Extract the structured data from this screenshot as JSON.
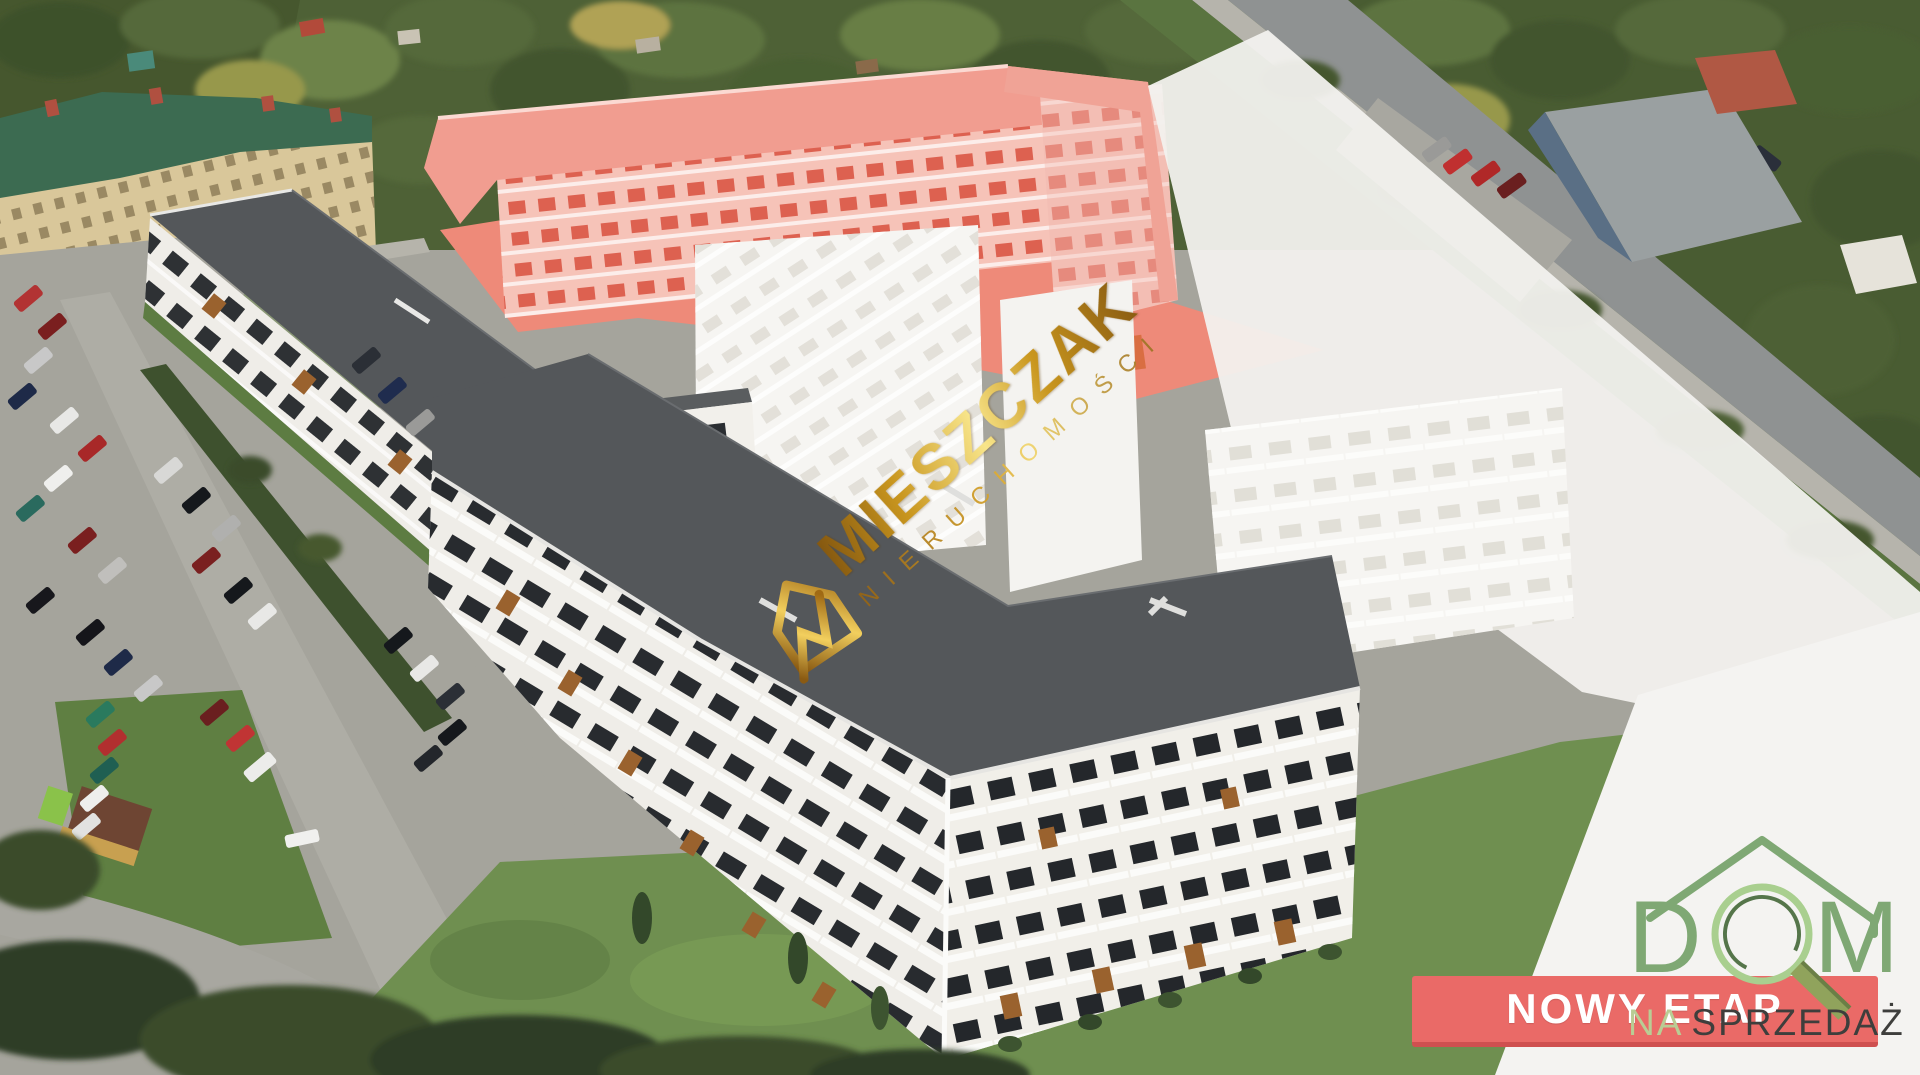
{
  "watermark": {
    "brand": "MIESZCZAK",
    "subtitle": "NIERUCHOMOŚCI",
    "house_icon": "gold-house-arrow-icon",
    "gold_dark": "#7a4d0e",
    "gold_mid": "#d9a62e",
    "gold_light": "#f8e58a"
  },
  "banner": {
    "label": "NOWY ETAP",
    "background": "#ea6a67",
    "border_color": "#cf5050",
    "text_color": "#ffffff"
  },
  "sale_caption": {
    "prefix": "NA",
    "word": "SPRZEDAŻ",
    "prefix_color": "#b9cd94",
    "word_color": "#3e3e3c"
  },
  "agency_logo": {
    "word": "DOM",
    "letter_d": "D",
    "letter_m": "M",
    "roof_icon": "green-roof-chevron-icon",
    "magnifier_icon": "green-magnifier-icon",
    "green": "#7fa874",
    "light_green": "#a9cf8f",
    "dark_green": "#55754a",
    "olive_handle": "#90a35c"
  },
  "scene": {
    "phase_highlight_red": "#ee8a79",
    "new_roof_gray": "#54575a",
    "facade_white": "#efede8",
    "future_phase_white": "#f2f1ee",
    "lawn_green": "#6f8f50",
    "asphalt_gray": "#a5a49c",
    "tree_green": "#4e6136",
    "accent_wood": "#9a622e"
  }
}
